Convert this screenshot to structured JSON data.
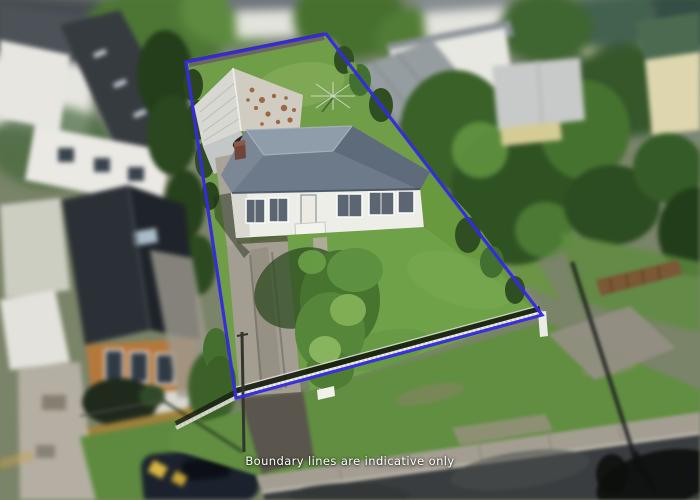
{
  "caption": {
    "text": "Boundary lines are indicative only"
  },
  "boundary": {
    "points": "186,62 326,34 542,315 236,398",
    "color": "#352adf",
    "stroke_width": "3.2"
  },
  "colors": {
    "boundary_blue": "#352adf",
    "caption_white": "#ffffff",
    "lawn_green": "#6f9d48",
    "roof_gray": "#727e8c",
    "house_white": "#eeeee8",
    "shed_rust": "#96552e",
    "asphalt_gray": "#3a3d3f",
    "concrete_gray": "#a39e91"
  }
}
